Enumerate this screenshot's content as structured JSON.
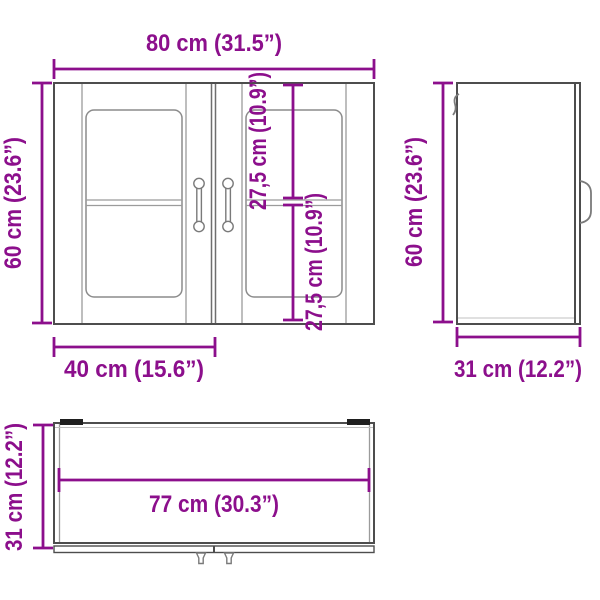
{
  "diagram": {
    "subject": "wall cabinet with glass doors - dimension drawing",
    "colors": {
      "accent": "#8C0F8C",
      "outline": "#4D4D4D",
      "secondary": "#9B9B9B",
      "background": "#FFFFFF"
    },
    "values_cm": {
      "total_width": 80,
      "total_height": 60,
      "total_depth": 31,
      "door_width": 40,
      "upper_glass_section": 27.5,
      "lower_glass_section": 27.5,
      "inner_width": 77
    }
  },
  "dims": {
    "front_width": "80 cm (31.5”)",
    "front_height": "60 cm (23.6”)",
    "front_upper_section": "27,5 cm (10.9”)",
    "front_lower_section": "27,5 cm (10.9”)",
    "front_door_width": "40 cm (15.6”)",
    "side_height": "60 cm (23.6”)",
    "side_depth": "31 cm (12.2”)",
    "bottom_inner_width": "77 cm (30.3”)",
    "bottom_depth": "31 cm (12.2”)"
  }
}
